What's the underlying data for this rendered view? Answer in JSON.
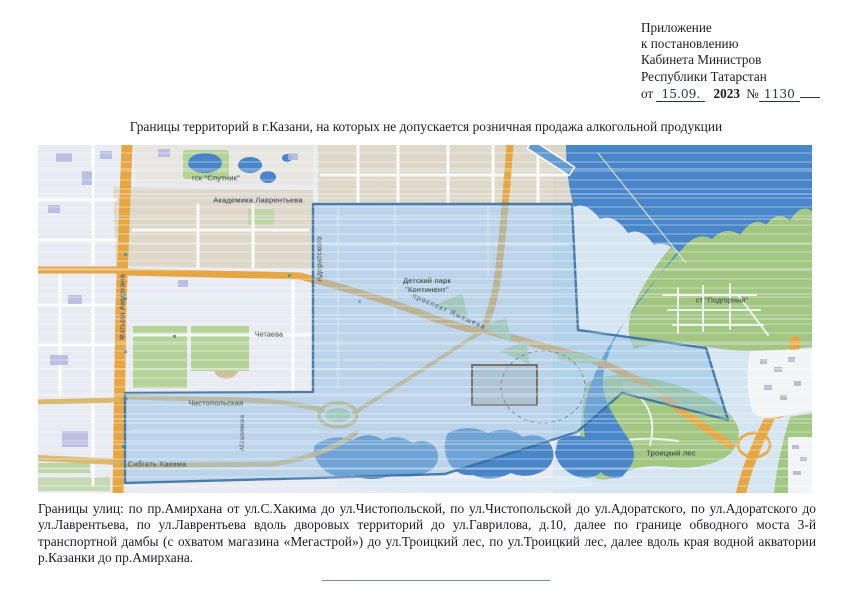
{
  "header": {
    "lines": [
      "Приложение",
      "к постановлению",
      "Кабинета Министров",
      "Республики Татарстан"
    ],
    "date_prefix": "от",
    "date_value": "15.09.",
    "year": "2023",
    "number_sign": "№",
    "number_value": "1130"
  },
  "title": "Границы территорий в г.Казани, на которых не допускается розничная продажа алкогольной продукции",
  "description": "Границы улиц: по пр.Амирхана от ул.С.Хакима до ул.Чистопольской, по ул.Чистопольской до ул.Адоратского, по ул.Адоратского до ул.Лаврентьева, по ул.Лаврентьева вдоль дворовых территорий до ул.Гаврилова, д.10, далее по границе обводного моста 3-й транспортной дамбы (с охватом магазина «Мегастрой») до ул.Троицкий лес, по ул.Троицкий лес, далее вдоль края водной акватории р.Казанки до пр.Амирхана.",
  "map": {
    "labels": {
      "gsk_sputnik": "гск \"Спутник\"",
      "akademika_lavrentyeva": "Академика Лаврентьева",
      "fatykha_amirkhana": "Фатыха Амирхана",
      "adoratskogo": "Адоратского",
      "detsky_park_line1": "Детский парк",
      "detsky_park_line2": "\"Континент\"",
      "prospekt_yamasheva": "проспект Ямашева",
      "chetaeva": "Четаева",
      "chistopolskaya": "Чистопольская",
      "sibgat_khakima": "Сибгать Хакима",
      "absalyamova": "Абсалямова",
      "st_podgorny": "ст \"Подгорный\"",
      "troitsky_les": "Троицкий лес"
    },
    "colors": {
      "restricted_zone_fill": "#8fc0e4",
      "restricted_zone_border": "#2e6da4",
      "water_dark": "#4486d0",
      "water_light": "#d4e5f2",
      "forest_green": "#9fc87e",
      "park_green": "#b3d494",
      "road_orange": "#eda93d",
      "urban_tan": "#d9d0b8",
      "urban_base": "#e9ebf3",
      "megastroy_outline": "#6b5d4f"
    }
  }
}
